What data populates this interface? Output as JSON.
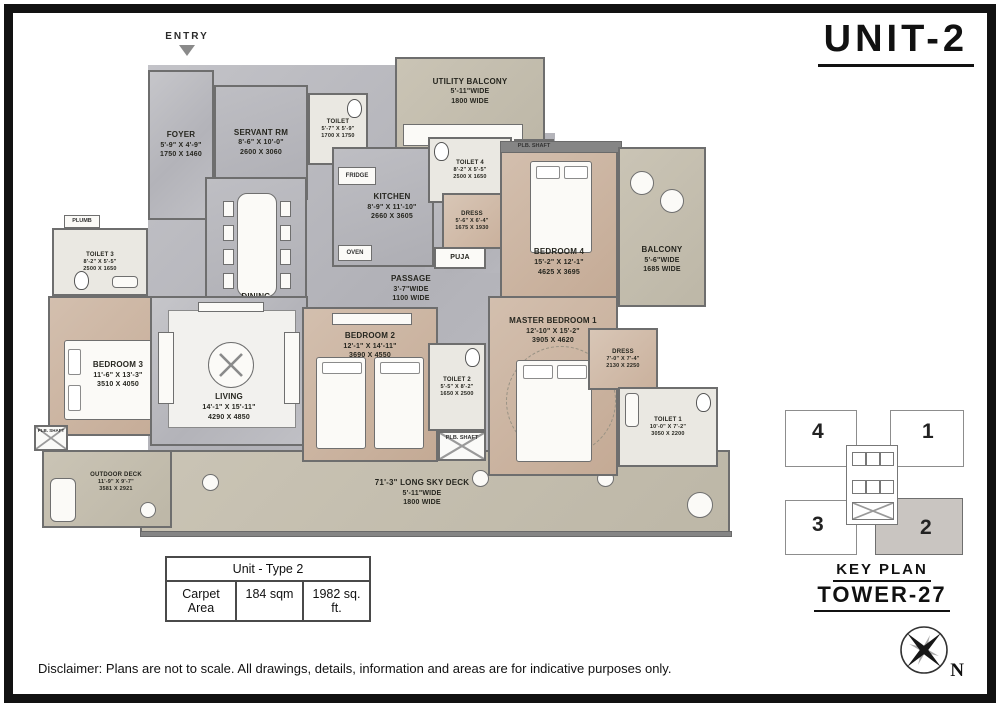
{
  "title": "UNIT-2",
  "entry_label": "ENTRY",
  "rooms": {
    "foyer": {
      "name": "FOYER",
      "ft": "5'-9\" X 4'-9\"",
      "mm": "1750 X 1460"
    },
    "servant": {
      "name": "SERVANT RM",
      "ft": "8'-6\" X 10'-0\"",
      "mm": "2600 X 3060"
    },
    "servant_toilet": {
      "name": "TOILET",
      "ft": "5'-7\" X 5'-9\"",
      "mm": "1700 X 1750"
    },
    "utility_balcony": {
      "name": "UTILITY BALCONY",
      "ft": "5'-11\"WIDE",
      "mm": "1800 WIDE"
    },
    "kitchen": {
      "name": "KITCHEN",
      "ft": "8'-9\" X 11'-10\"",
      "mm": "2660 X 3605"
    },
    "toilet4": {
      "name": "TOILET 4",
      "ft": "8'-2\" X 5'-5\"",
      "mm": "2500 X 1650"
    },
    "dining": {
      "name": "DINING",
      "ft": "17'-5\" X 15'-5\"",
      "mm": "5320 X 4700"
    },
    "passage": {
      "name": "PASSAGE",
      "ft": "3'-7\"WIDE",
      "mm": "1100 WIDE"
    },
    "puja": {
      "name": "PUJA"
    },
    "dress4": {
      "name": "DRESS",
      "ft": "5'-6\" X 6'-4\"",
      "mm": "1675 X 1930"
    },
    "bedroom4": {
      "name": "BEDROOM 4",
      "ft": "15'-2\" X 12'-1\"",
      "mm": "4625 X 3695"
    },
    "balcony": {
      "name": "BALCONY",
      "ft": "5'-6\"WIDE",
      "mm": "1685 WIDE"
    },
    "toilet3": {
      "name": "TOILET 3",
      "ft": "8'-2\" X 5'-5\"",
      "mm": "2500 X 1650"
    },
    "bedroom3": {
      "name": "BEDROOM 3",
      "ft": "11'-6\" X 13'-3\"",
      "mm": "3510 X 4050"
    },
    "living": {
      "name": "LIVING",
      "ft": "14'-1\" X 15'-11\"",
      "mm": "4290 X 4850"
    },
    "bedroom2": {
      "name": "BEDROOM 2",
      "ft": "12'-1\" X 14'-11\"",
      "mm": "3690 X 4550"
    },
    "toilet2": {
      "name": "TOILET 2",
      "ft": "5'-5\" X 8'-2\"",
      "mm": "1650 X 2500"
    },
    "master": {
      "name": "MASTER BEDROOM 1",
      "ft": "12'-10\" X 15'-2\"",
      "mm": "3905 X 4620"
    },
    "dress1": {
      "name": "DRESS",
      "ft": "7'-0\" X 7'-4\"",
      "mm": "2130 X 2250"
    },
    "toilet1": {
      "name": "TOILET 1",
      "ft": "10'-0\" X 7'-2\"",
      "mm": "3050 X 2200"
    },
    "outdoor_deck": {
      "name": "OUTDOOR DECK",
      "ft": "11'-9\" X 9'-7\"",
      "mm": "3581 X 2921"
    },
    "sky_deck": {
      "name": "71'-3\" LONG SKY DECK",
      "ft": "5'-11\"WIDE",
      "mm": "1800 WIDE"
    }
  },
  "fixtures": {
    "fridge": "FRIDGE",
    "oven": "OVEN",
    "plb_shaft": "PLB. SHAFT",
    "plumb": "PLUMB"
  },
  "area_table": {
    "header": "Unit - Type 2",
    "row_label": "Carpet Area",
    "sqm": "184 sqm",
    "sqft": "1982 sq. ft."
  },
  "key_plan": {
    "title": "KEY PLAN",
    "tower": "TOWER-27",
    "units": [
      "4",
      "1",
      "3",
      "2"
    ],
    "highlighted_unit": "2",
    "highlight_color": "#c9c5c1"
  },
  "compass": {
    "label": "N"
  },
  "disclaimer": "Disclaimer: Plans are not to scale. All drawings, details, information and areas are for indicative purposes only."
}
